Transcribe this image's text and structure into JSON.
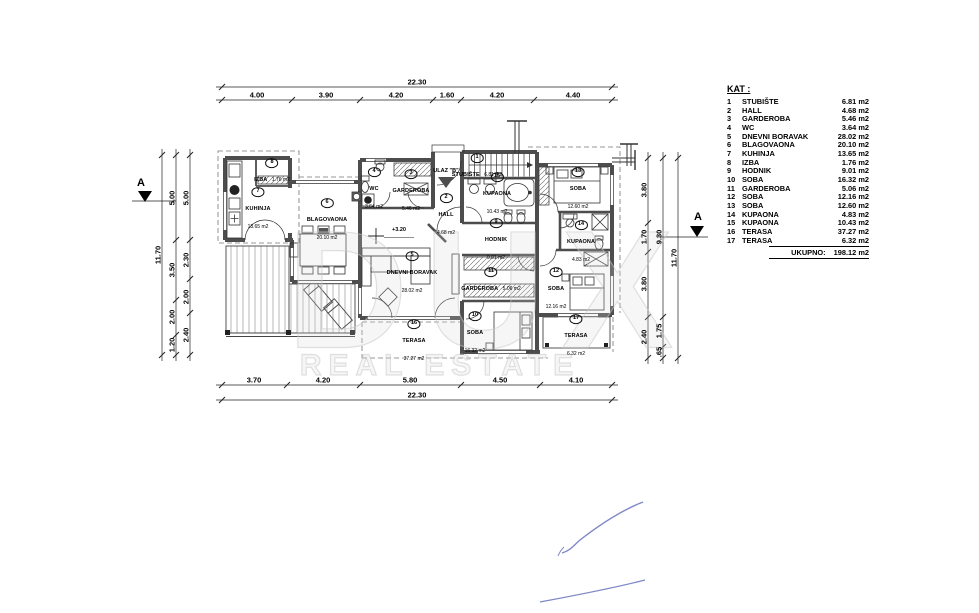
{
  "legend": {
    "title": "KAT :",
    "items": [
      {
        "num": "1",
        "name": "STUBIŠTE",
        "area": "6.81 m2"
      },
      {
        "num": "2",
        "name": "HALL",
        "area": "4.68 m2"
      },
      {
        "num": "3",
        "name": "GARDEROBA",
        "area": "5.46 m2"
      },
      {
        "num": "4",
        "name": "WC",
        "area": "3.64 m2"
      },
      {
        "num": "5",
        "name": "DNEVNI BORAVAK",
        "area": "28.02 m2"
      },
      {
        "num": "6",
        "name": "BLAGOVAONA",
        "area": "20.10 m2"
      },
      {
        "num": "7",
        "name": "KUHINJA",
        "area": "13.65 m2"
      },
      {
        "num": "8",
        "name": "IZBA",
        "area": "1.76 m2"
      },
      {
        "num": "9",
        "name": "HODNIK",
        "area": "9.01 m2"
      },
      {
        "num": "10",
        "name": "SOBA",
        "area": "16.32 m2"
      },
      {
        "num": "11",
        "name": "GARDEROBA",
        "area": "5.06 m2"
      },
      {
        "num": "12",
        "name": "SOBA",
        "area": "12.16 m2"
      },
      {
        "num": "13",
        "name": "SOBA",
        "area": "12.60 m2"
      },
      {
        "num": "14",
        "name": "KUPAONA",
        "area": "4.83 m2"
      },
      {
        "num": "15",
        "name": "KUPAONA",
        "area": "10.43 m2"
      },
      {
        "num": "16",
        "name": "TERASA",
        "area": "37.27 m2"
      },
      {
        "num": "17",
        "name": "TERASA",
        "area": "6.32 m2"
      }
    ],
    "total_label": "UKUPNO:",
    "total_value": "198.12 m2"
  },
  "rooms": [
    {
      "num": "1",
      "name": "STUBIŠTE",
      "area": "6.81 m2"
    },
    {
      "num": "2",
      "name": "HALL",
      "area": "4.68 m2"
    },
    {
      "num": "3",
      "name": "GARDEROBA",
      "area": "5.46 m2"
    },
    {
      "num": "4",
      "name": "WC",
      "area": "3.64 m2"
    },
    {
      "num": "5",
      "name": "DNEVNI BORAVAK",
      "area": "28.02 m2"
    },
    {
      "num": "6",
      "name": "BLAGOVAONA",
      "area": "20.10 m2"
    },
    {
      "num": "7",
      "name": "KUHINJA",
      "area": "13.65 m2"
    },
    {
      "num": "8",
      "name": "IZBA",
      "area": "1.76 m2"
    },
    {
      "num": "9",
      "name": "HODNIK",
      "area": "9.01 m2"
    },
    {
      "num": "10",
      "name": "SOBA",
      "area": "16.32 m2"
    },
    {
      "num": "11",
      "name": "GARDEROBA",
      "area": "5.06 m2"
    },
    {
      "num": "12",
      "name": "SOBA",
      "area": "12.16 m2"
    },
    {
      "num": "13",
      "name": "SOBA",
      "area": "12.60 m2"
    },
    {
      "num": "14",
      "name": "KUPAONA",
      "area": "4.83 m2"
    },
    {
      "num": "15",
      "name": "KUPAONA",
      "area": "10.43 m2"
    },
    {
      "num": "16",
      "name": "TERASA",
      "area": "37.27 m2"
    },
    {
      "num": "17",
      "name": "TERASA",
      "area": "6.32 m2"
    }
  ],
  "dimensions": {
    "top": {
      "total": "22.30",
      "segments": [
        "4.00",
        "3.90",
        "4.20",
        "1.60",
        "4.20",
        "4.40"
      ]
    },
    "bottom": {
      "total": "22.30",
      "segments": [
        "3.70",
        "4.20",
        "5.80",
        "4.50",
        "4.10"
      ]
    },
    "left": {
      "total": "11.70",
      "middle": [
        "5.00",
        "3.50",
        "2.00",
        "1.20"
      ],
      "inner": [
        "5.00",
        "2.30",
        "2.00",
        "2.40"
      ]
    },
    "right": {
      "total": "11.70",
      "middle": [
        "9.30",
        "1.75",
        ".65"
      ],
      "inner": [
        "3.80",
        "1.70",
        "3.80",
        "2.40"
      ]
    }
  },
  "markers": {
    "section": "A",
    "entrance": "ULAZ \"B\"",
    "level": "+3.20"
  },
  "watermark": {
    "brand": "DUX",
    "subtitle": "REAL ESTATE"
  }
}
